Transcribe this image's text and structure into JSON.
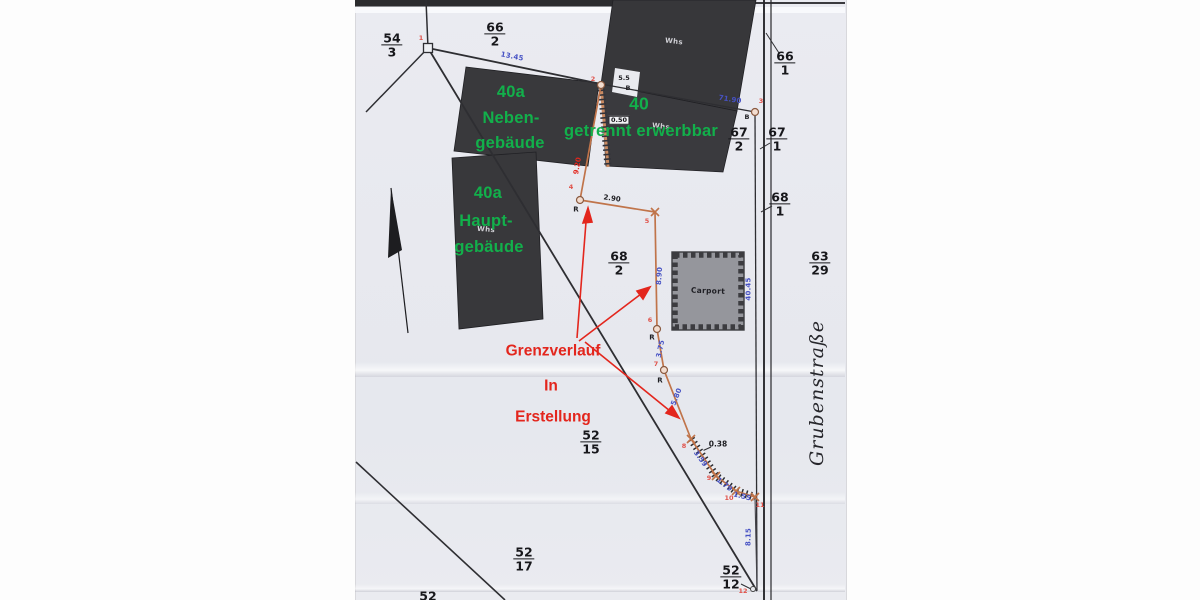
{
  "map": {
    "street_name": "Grubenstraße",
    "colors": {
      "green": "#12b04b",
      "red": "#e3261d",
      "blue": "#4752c4",
      "ptred": "#e0524a",
      "orange": "#c0744a",
      "dark": "#2e2e33",
      "building": "#3a3a3e",
      "carport": "#95969c",
      "scan": "#e9eaef"
    },
    "annotations": {
      "green_note_1": [
        "40a",
        "Neben-",
        "gebäude"
      ],
      "green_note_2": [
        "40",
        "getrennt erwerbbar"
      ],
      "green_note_3": [
        "40a",
        "Haupt-",
        "gebäude"
      ],
      "red_note": [
        "Grenzverlauf",
        "In",
        "Erstellung"
      ]
    },
    "parcels": [
      {
        "num": "54",
        "den": "3",
        "x": 392,
        "y": 45
      },
      {
        "num": "66",
        "den": "2",
        "x": 495,
        "y": 34
      },
      {
        "num": "66",
        "den": "1",
        "x": 785,
        "y": 63
      },
      {
        "num": "67",
        "den": "2",
        "x": 739,
        "y": 139
      },
      {
        "num": "67",
        "den": "1",
        "x": 777,
        "y": 139
      },
      {
        "num": "68",
        "den": "1",
        "x": 780,
        "y": 204
      },
      {
        "num": "68",
        "den": "2",
        "x": 619,
        "y": 263
      },
      {
        "num": "63",
        "den": "29",
        "x": 820,
        "y": 263
      },
      {
        "num": "52",
        "den": "15",
        "x": 591,
        "y": 442
      },
      {
        "num": "52",
        "den": "17",
        "x": 524,
        "y": 559
      },
      {
        "num": "52",
        "den": "12",
        "x": 731,
        "y": 577
      },
      {
        "num": "52",
        "x": 428,
        "y": 596
      }
    ],
    "labels": [
      {
        "t": "13.45",
        "x": 512,
        "y": 57,
        "r": 11,
        "cls": "mb",
        "name": "measurement-13-45"
      },
      {
        "t": "71.90",
        "x": 730,
        "y": 100,
        "r": 9,
        "cls": "mb",
        "name": "measurement-71-90"
      },
      {
        "t": "8.90",
        "x": 660,
        "y": 276,
        "r": -86,
        "cls": "mb",
        "name": "measurement-8-90"
      },
      {
        "t": "40.45",
        "x": 749,
        "y": 289,
        "r": -90,
        "cls": "mb",
        "name": "measurement-40-45"
      },
      {
        "t": "3.75",
        "x": 661,
        "y": 349,
        "r": -78,
        "cls": "mb",
        "name": "measurement-3-75"
      },
      {
        "t": "5.80",
        "x": 677,
        "y": 397,
        "r": -68,
        "cls": "mb",
        "name": "measurement-5-80"
      },
      {
        "t": "3.59",
        "x": 700,
        "y": 459,
        "r": 54,
        "cls": "mb",
        "name": "measurement-3-59"
      },
      {
        "t": "1.79",
        "x": 724,
        "y": 485,
        "r": 38,
        "cls": "mb",
        "name": "measurement-1-79"
      },
      {
        "t": "1.55",
        "x": 742,
        "y": 497,
        "r": 14,
        "cls": "mb",
        "name": "measurement-1-55"
      },
      {
        "t": "8.15",
        "x": 749,
        "y": 537,
        "r": -89,
        "cls": "mb",
        "name": "measurement-8-15"
      },
      {
        "t": "9.20",
        "x": 578,
        "y": 166,
        "r": -80,
        "cls": "mr",
        "name": "measurement-9-20"
      },
      {
        "t": "2.90",
        "x": 612,
        "y": 199,
        "r": 8,
        "cls": "md",
        "name": "measurement-2-90"
      },
      {
        "t": "0.38",
        "x": 718,
        "y": 444,
        "fs": 7.5,
        "cls": "md",
        "name": "measurement-0-38"
      },
      {
        "t": "0.50",
        "x": 619,
        "y": 120,
        "cls": "mbox",
        "name": "measurement-0-50-boxed"
      },
      {
        "t": "5.5",
        "x": 624,
        "y": 78,
        "fs": 6.5,
        "cls": "md",
        "name": "measurement-5-5"
      },
      {
        "t": "B",
        "x": 628,
        "y": 88,
        "fs": 6.5,
        "cls": "md",
        "name": "point-letter-b-1"
      },
      {
        "t": "B",
        "x": 747,
        "y": 117,
        "fs": 6.5,
        "cls": "md",
        "name": "point-letter-b-2"
      },
      {
        "t": "R",
        "x": 576,
        "y": 210,
        "cls": "md",
        "name": "point-letter-r-1"
      },
      {
        "t": "R",
        "x": 652,
        "y": 338,
        "cls": "md",
        "name": "point-letter-r-2"
      },
      {
        "t": "R",
        "x": 660,
        "y": 381,
        "cls": "md",
        "name": "point-letter-r-3"
      },
      {
        "t": "1",
        "x": 421,
        "y": 38,
        "cls": "pn",
        "name": "point-number-1"
      },
      {
        "t": "2",
        "x": 593,
        "y": 79,
        "cls": "pn",
        "name": "point-number-2"
      },
      {
        "t": "3",
        "x": 761,
        "y": 101,
        "cls": "pn",
        "name": "point-number-3"
      },
      {
        "t": "4",
        "x": 571,
        "y": 187,
        "cls": "pn",
        "name": "point-number-4"
      },
      {
        "t": "5",
        "x": 647,
        "y": 221,
        "cls": "pn",
        "name": "point-number-5"
      },
      {
        "t": "6",
        "x": 650,
        "y": 320,
        "cls": "pn",
        "name": "point-number-6"
      },
      {
        "t": "7",
        "x": 656,
        "y": 364,
        "cls": "pn",
        "name": "point-number-7"
      },
      {
        "t": "8",
        "x": 684,
        "y": 446,
        "cls": "pn",
        "name": "point-number-8"
      },
      {
        "t": "9",
        "x": 709,
        "y": 478,
        "cls": "pn",
        "name": "point-number-9"
      },
      {
        "t": "10",
        "x": 729,
        "y": 498,
        "cls": "pn",
        "name": "point-number-10"
      },
      {
        "t": "11",
        "x": 760,
        "y": 505,
        "cls": "pn",
        "name": "point-number-11"
      },
      {
        "t": "12",
        "x": 743,
        "y": 591,
        "cls": "pn",
        "name": "point-number-12"
      },
      {
        "t": "Whs",
        "x": 674,
        "y": 42,
        "r": 6,
        "cls": "bw",
        "name": "building-label-whs-1"
      },
      {
        "t": "Whs",
        "x": 661,
        "y": 127,
        "r": 6,
        "cls": "bw",
        "name": "building-label-whs-2"
      },
      {
        "t": "Whs",
        "x": 486,
        "y": 230,
        "r": 5,
        "cls": "bw",
        "name": "building-label-whs-3"
      },
      {
        "t": "Carport",
        "x": 708,
        "y": 291,
        "r": 2,
        "cls": "cp",
        "name": "building-label-carport"
      },
      {
        "t": "40a",
        "x": 511,
        "y": 92,
        "cls": "ga",
        "name": "green-note-40a-neben-line1"
      },
      {
        "t": "Neben-",
        "x": 511,
        "y": 118,
        "cls": "ga",
        "name": "green-note-40a-neben-line2"
      },
      {
        "t": "gebäude",
        "x": 510,
        "y": 143,
        "cls": "ga",
        "name": "green-note-40a-neben-line3"
      },
      {
        "t": "40",
        "x": 639,
        "y": 104,
        "fs": 17.5,
        "cls": "ga",
        "name": "green-note-40-line1"
      },
      {
        "t": "getrennt erwerbbar",
        "x": 641,
        "y": 131,
        "cls": "ga",
        "name": "green-note-40-line2"
      },
      {
        "t": "40a",
        "x": 488,
        "y": 193,
        "cls": "ga",
        "name": "green-note-40a-haupt-line1"
      },
      {
        "t": "Haupt-",
        "x": 486,
        "y": 221,
        "cls": "ga",
        "name": "green-note-40a-haupt-line2"
      },
      {
        "t": "gebäude",
        "x": 489,
        "y": 247,
        "cls": "ga",
        "name": "green-note-40a-haupt-line3"
      },
      {
        "t": "Grenzverlauf",
        "x": 553,
        "y": 351,
        "cls": "ra",
        "name": "red-note-grenzverlauf"
      },
      {
        "t": "In",
        "x": 551,
        "y": 386,
        "cls": "ra",
        "name": "red-note-in"
      },
      {
        "t": "Erstellung",
        "x": 553,
        "y": 417,
        "cls": "ra",
        "name": "red-note-erstellung"
      }
    ]
  }
}
